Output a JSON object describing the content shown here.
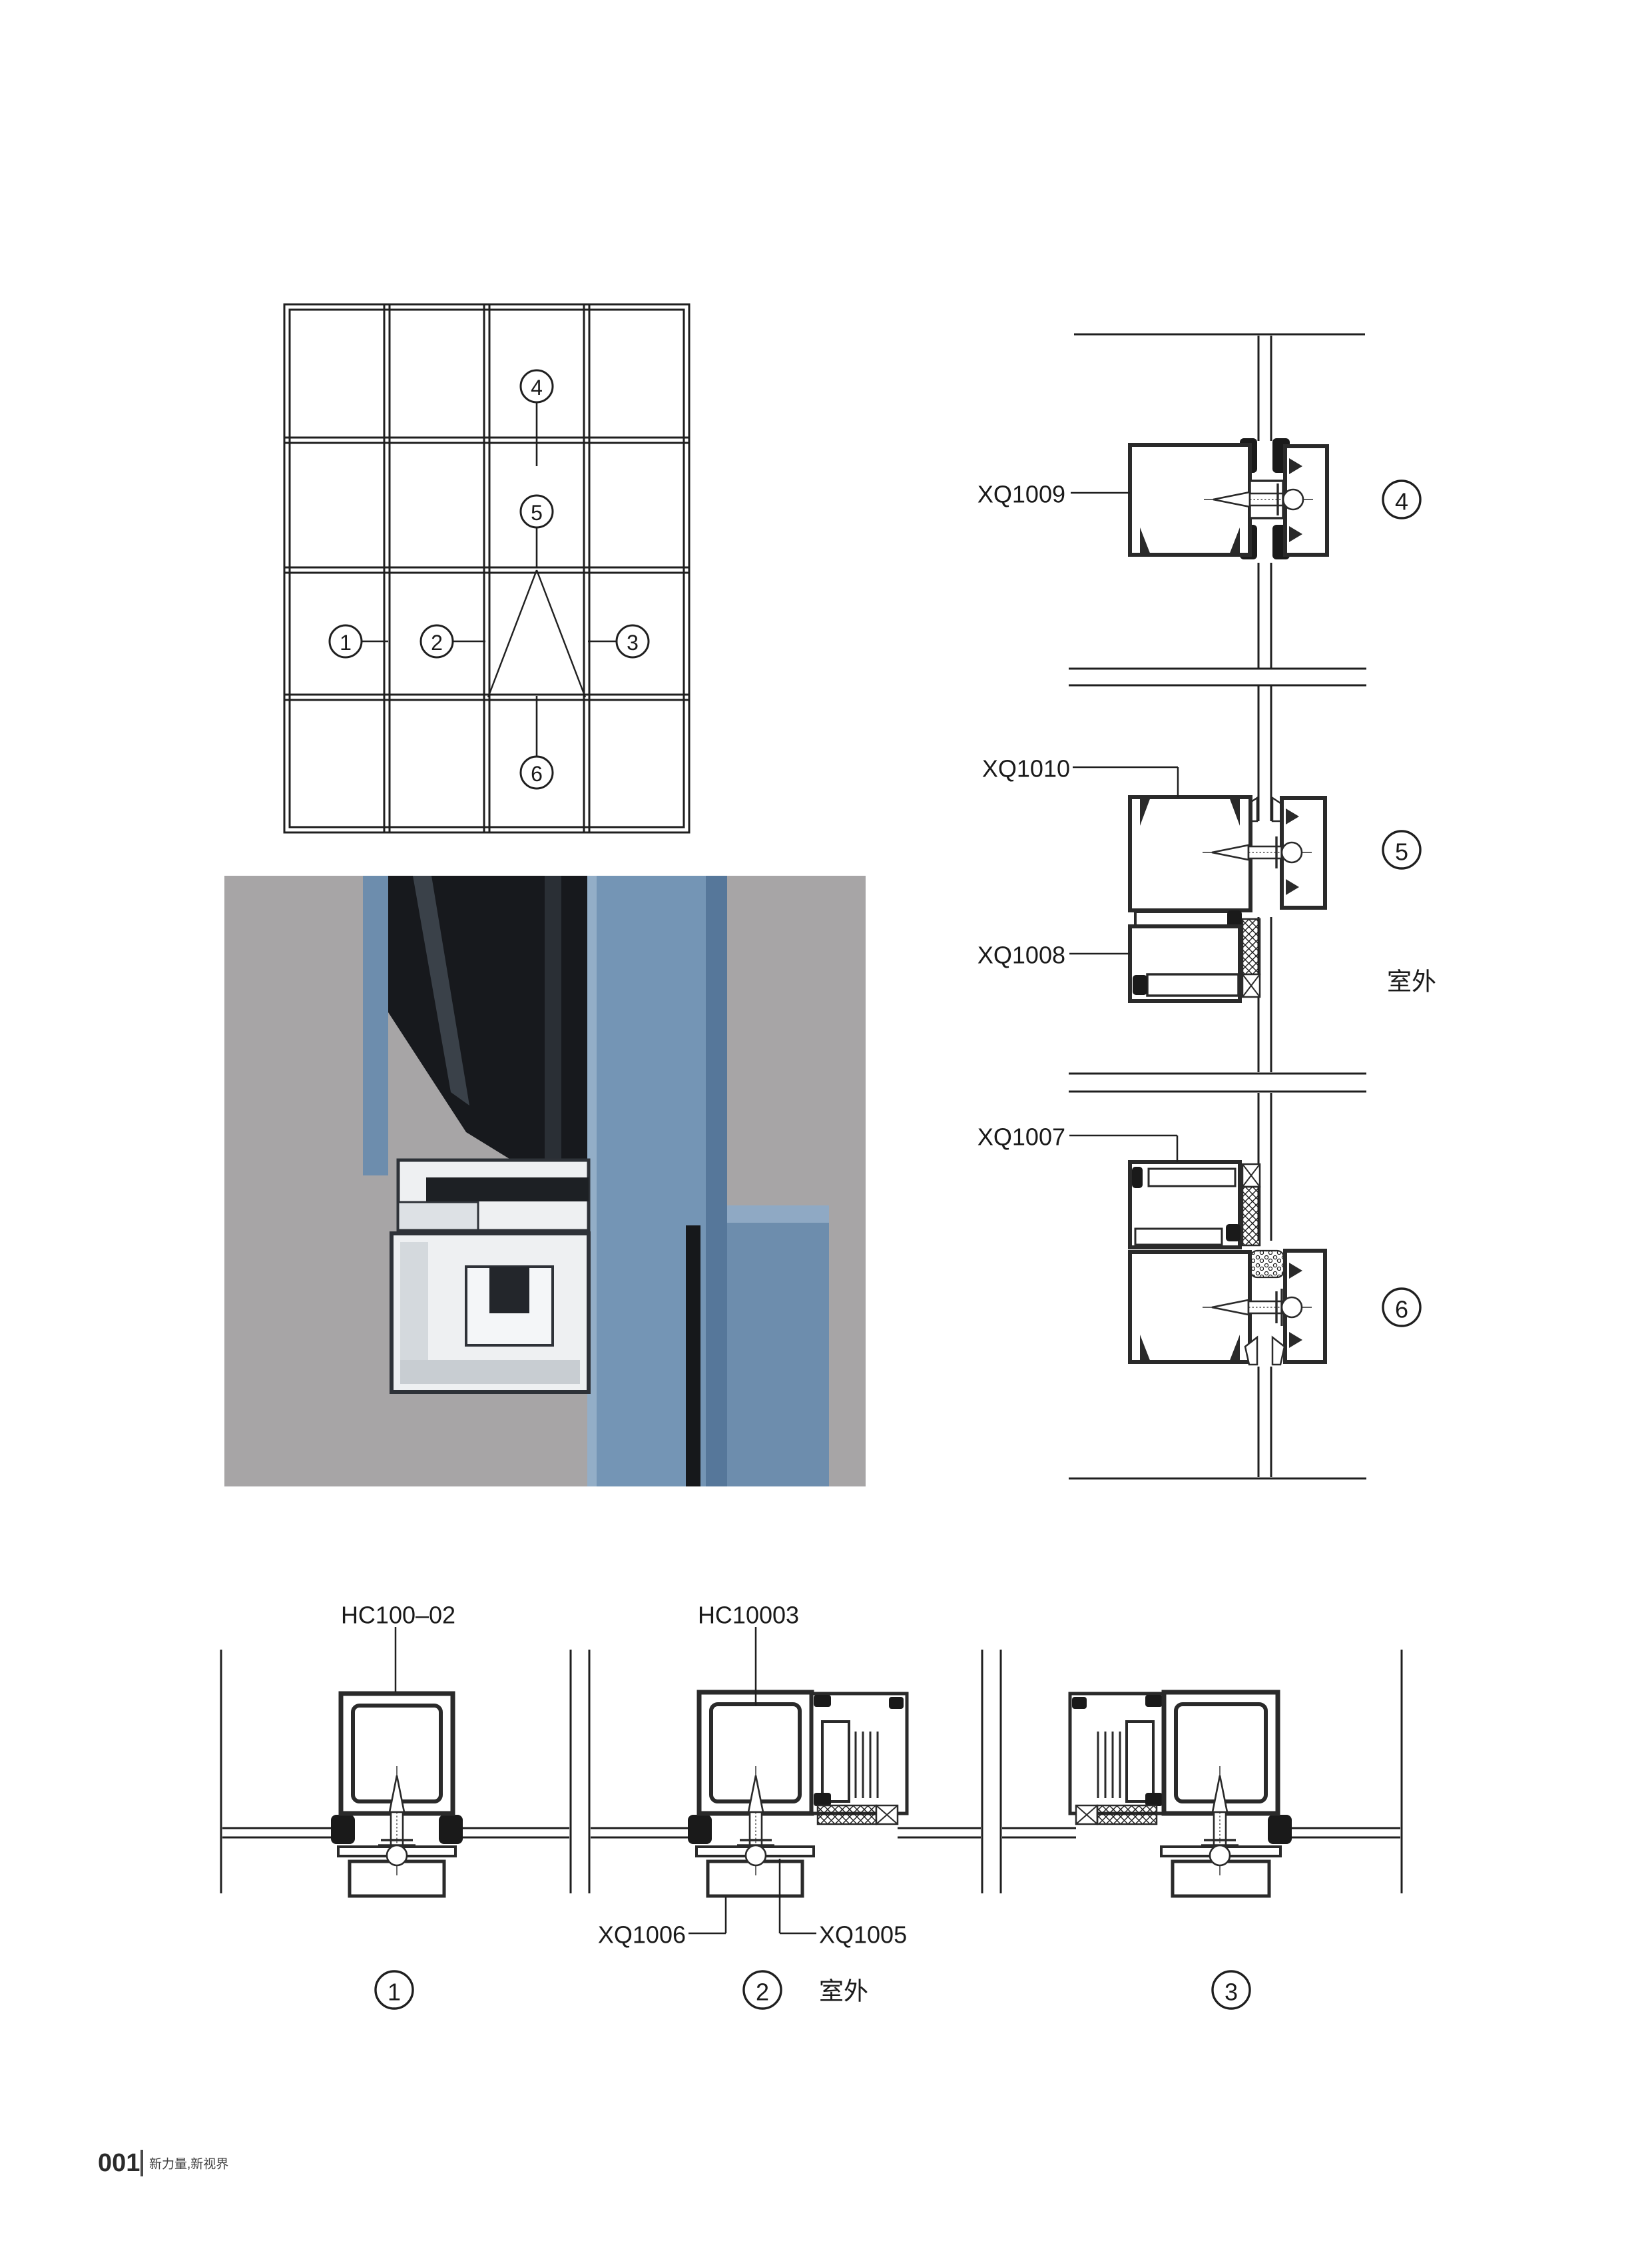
{
  "callouts": {
    "c1": "1",
    "c2": "2",
    "c3": "3",
    "c4": "4",
    "c5": "5",
    "c6": "6"
  },
  "section_labels": {
    "xq1009": "XQ1009",
    "xq1010": "XQ1010",
    "xq1008": "XQ1008",
    "xq1007": "XQ1007"
  },
  "plan_labels": {
    "hc100_02": "HC100–02",
    "hc10003": "HC10003",
    "xq1006": "XQ1006",
    "xq1005": "XQ1005"
  },
  "outdoor_label": "室外",
  "footer": {
    "page_number": "001",
    "slogan": "新力量,新视界"
  },
  "colors": {
    "line": "#2a2a2a",
    "render_bg": "#a7a5a6",
    "aluminum_blue": "#7495b5",
    "glass_dark": "#17191d",
    "cut_face": "#eef0f2"
  }
}
